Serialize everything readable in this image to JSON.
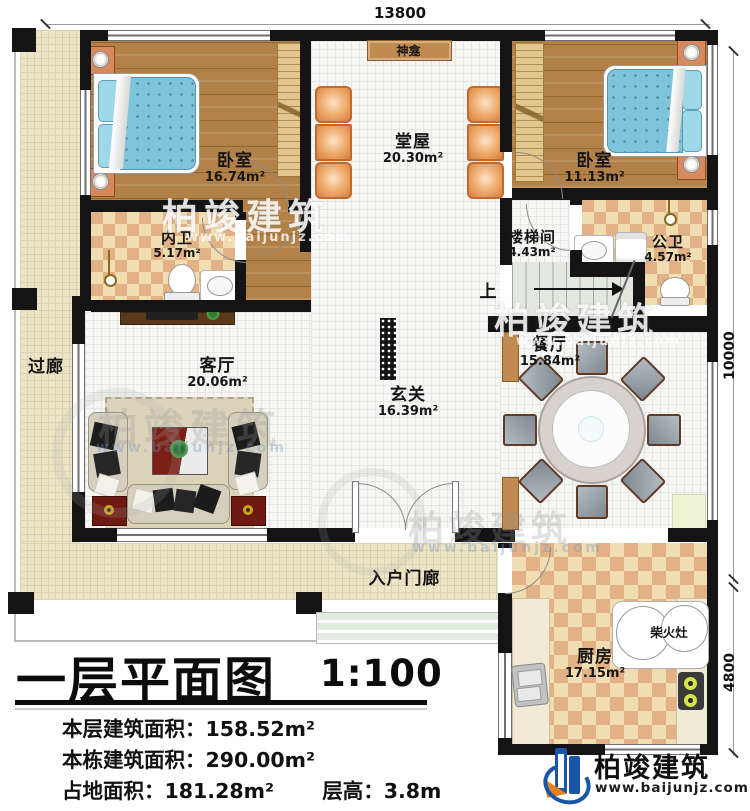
{
  "dimensions": {
    "top": "13800",
    "right_upper": "10000",
    "right_lower": "4800"
  },
  "rooms": {
    "bedroom_left": {
      "name": "卧室",
      "area": "16.74m²"
    },
    "inner_bath": {
      "name": "内卫",
      "area": "5.17m²"
    },
    "main_hall": {
      "name": "堂屋",
      "area": "20.30m²"
    },
    "bedroom_right": {
      "name": "卧室",
      "area": "11.13m²"
    },
    "stairwell": {
      "name": "楼梯间",
      "area": "4.43m²"
    },
    "public_bath": {
      "name": "公卫",
      "area": "4.57m²"
    },
    "dining": {
      "name": "餐厅",
      "area": "15.84m²"
    },
    "foyer": {
      "name": "玄关",
      "area": "16.39m²"
    },
    "living": {
      "name": "客厅",
      "area": "20.06m²"
    },
    "corridor": {
      "name": "过廊"
    },
    "porch": {
      "name": "入户门廊"
    },
    "kitchen": {
      "name": "厨房",
      "area": "17.15m²"
    }
  },
  "features": {
    "shrine": "神龛",
    "firewood_stove": "柴火灶",
    "stairs_up": "上"
  },
  "title_block": {
    "title": "一层平面图",
    "scale": "1:100",
    "stats": [
      {
        "label": "本层建筑面积：",
        "value": "158.52m²"
      },
      {
        "label": "本栋建筑面积：",
        "value": "290.00m²"
      },
      {
        "label": "占地面积：",
        "value": "181.28m²"
      },
      {
        "label": "层高：",
        "value": "3.8m"
      }
    ]
  },
  "branding": {
    "company": "柏竣建筑",
    "website": "www.baijunjz.com"
  },
  "colors": {
    "wall": "#141414",
    "wood_floor": "#b28147",
    "check_light": "#f0ddb2",
    "check_dark": "#e2b286",
    "brand_blue": "#1a56a8",
    "brand_orange": "#e8801e"
  }
}
